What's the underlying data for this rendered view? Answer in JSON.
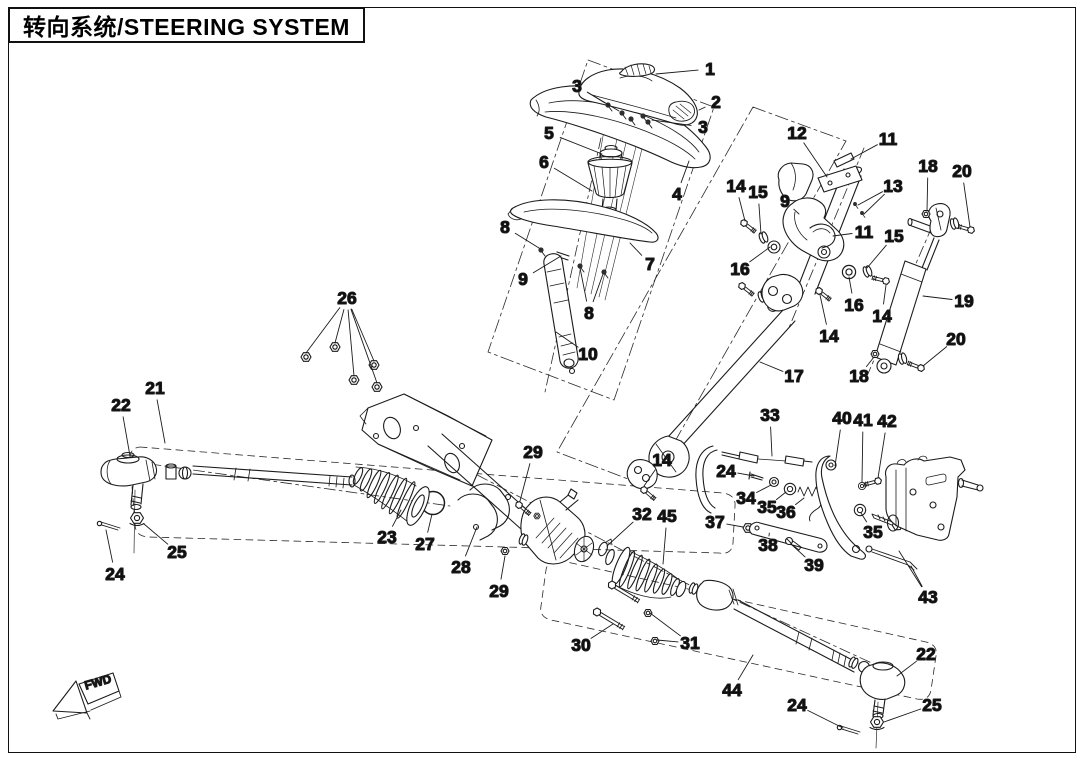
{
  "title": {
    "text": "转向系统/STEERING SYSTEM"
  },
  "fwd": {
    "label": "FWD"
  },
  "colors": {
    "ink": "#1b1b1b",
    "paper": "#ffffff"
  },
  "callouts": [
    {
      "n": "1",
      "x": 710,
      "y": 69,
      "t": [
        [
          656,
          74
        ]
      ]
    },
    {
      "n": "2",
      "x": 716,
      "y": 102,
      "t": [
        [
          699,
          110
        ]
      ]
    },
    {
      "n": "3",
      "x": 577,
      "y": 86,
      "t": [
        [
          605,
          103
        ],
        [
          619,
          111
        ]
      ]
    },
    {
      "n": "3",
      "x": 703,
      "y": 127,
      "t": [
        [
          652,
          120
        ]
      ]
    },
    {
      "n": "4",
      "x": 677,
      "y": 194,
      "t": [
        [
          689,
          161
        ]
      ]
    },
    {
      "n": "5",
      "x": 549,
      "y": 133,
      "t": [
        [
          602,
          154
        ]
      ]
    },
    {
      "n": "6",
      "x": 544,
      "y": 162,
      "t": [
        [
          592,
          191
        ]
      ]
    },
    {
      "n": "7",
      "x": 650,
      "y": 264,
      "t": [
        [
          630,
          243
        ]
      ]
    },
    {
      "n": "8",
      "x": 505,
      "y": 227,
      "t": [
        [
          539,
          248
        ]
      ]
    },
    {
      "n": "9",
      "x": 523,
      "y": 279,
      "t": [
        [
          561,
          256
        ]
      ]
    },
    {
      "n": "8",
      "x": 589,
      "y": 313,
      "t": [
        [
          580,
          268
        ],
        [
          603,
          274
        ]
      ]
    },
    {
      "n": "10",
      "x": 588,
      "y": 354,
      "t": [
        [
          556,
          332
        ]
      ]
    },
    {
      "n": "12",
      "x": 797,
      "y": 133,
      "t": [
        [
          827,
          177
        ]
      ]
    },
    {
      "n": "11",
      "x": 888,
      "y": 139,
      "t": [
        [
          851,
          159
        ]
      ]
    },
    {
      "n": "13",
      "x": 893,
      "y": 186,
      "t": [
        [
          858,
          205
        ],
        [
          864,
          214
        ]
      ]
    },
    {
      "n": "14",
      "x": 736,
      "y": 186,
      "t": [
        [
          745,
          221
        ]
      ]
    },
    {
      "n": "15",
      "x": 758,
      "y": 192,
      "t": [
        [
          761,
          234
        ]
      ]
    },
    {
      "n": "9",
      "x": 785,
      "y": 201,
      "t": [
        [
          799,
          214
        ]
      ]
    },
    {
      "n": "11",
      "x": 864,
      "y": 232,
      "t": [
        [
          833,
          236
        ]
      ]
    },
    {
      "n": "15",
      "x": 894,
      "y": 236,
      "t": [
        [
          867,
          268
        ]
      ]
    },
    {
      "n": "16",
      "x": 740,
      "y": 269,
      "t": [
        [
          770,
          247
        ]
      ]
    },
    {
      "n": "16",
      "x": 854,
      "y": 305,
      "t": [
        [
          849,
          277
        ]
      ]
    },
    {
      "n": "14",
      "x": 882,
      "y": 316,
      "t": [
        [
          886,
          285
        ]
      ]
    },
    {
      "n": "14",
      "x": 829,
      "y": 336,
      "t": [
        [
          820,
          295
        ]
      ]
    },
    {
      "n": "18",
      "x": 928,
      "y": 166,
      "t": [
        [
          927,
          211
        ]
      ]
    },
    {
      "n": "20",
      "x": 962,
      "y": 171,
      "t": [
        [
          970,
          227
        ]
      ]
    },
    {
      "n": "19",
      "x": 964,
      "y": 301,
      "t": [
        [
          923,
          296
        ]
      ]
    },
    {
      "n": "20",
      "x": 956,
      "y": 339,
      "t": [
        [
          923,
          366
        ]
      ]
    },
    {
      "n": "18",
      "x": 859,
      "y": 376,
      "t": [
        [
          874,
          357
        ]
      ]
    },
    {
      "n": "17",
      "x": 794,
      "y": 376,
      "t": [
        [
          760,
          362
        ]
      ]
    },
    {
      "n": "26",
      "x": 347,
      "y": 298,
      "t": [
        [
          306,
          353
        ],
        [
          335,
          343
        ],
        [
          354,
          376
        ],
        [
          374,
          361
        ],
        [
          377,
          383
        ]
      ]
    },
    {
      "n": "21",
      "x": 155,
      "y": 388,
      "t": [
        [
          165,
          443
        ]
      ]
    },
    {
      "n": "22",
      "x": 121,
      "y": 405,
      "t": [
        [
          130,
          456
        ]
      ]
    },
    {
      "n": "23",
      "x": 387,
      "y": 537,
      "t": [
        [
          401,
          510
        ]
      ]
    },
    {
      "n": "27",
      "x": 425,
      "y": 544,
      "t": [
        [
          432,
          514
        ]
      ]
    },
    {
      "n": "25",
      "x": 177,
      "y": 552,
      "t": [
        [
          144,
          524
        ]
      ]
    },
    {
      "n": "24",
      "x": 115,
      "y": 574,
      "t": [
        [
          106,
          530
        ]
      ]
    },
    {
      "n": "29",
      "x": 533,
      "y": 452,
      "t": [
        [
          520,
          501
        ]
      ]
    },
    {
      "n": "14",
      "x": 662,
      "y": 460,
      "t": [
        [
          644,
          486
        ]
      ]
    },
    {
      "n": "32",
      "x": 642,
      "y": 514,
      "t": [
        [
          607,
          546
        ]
      ]
    },
    {
      "n": "45",
      "x": 667,
      "y": 516,
      "t": [
        [
          663,
          564
        ]
      ]
    },
    {
      "n": "28",
      "x": 461,
      "y": 567,
      "t": [
        [
          477,
          527
        ]
      ]
    },
    {
      "n": "29",
      "x": 499,
      "y": 591,
      "t": [
        [
          505,
          556
        ]
      ]
    },
    {
      "n": "30",
      "x": 581,
      "y": 645,
      "t": [
        [
          613,
          624
        ]
      ]
    },
    {
      "n": "31",
      "x": 690,
      "y": 643,
      "t": [
        [
          650,
          613
        ],
        [
          657,
          640
        ]
      ]
    },
    {
      "n": "44",
      "x": 732,
      "y": 690,
      "t": [
        [
          753,
          655
        ]
      ]
    },
    {
      "n": "22",
      "x": 926,
      "y": 654,
      "t": [
        [
          897,
          676
        ]
      ]
    },
    {
      "n": "24",
      "x": 797,
      "y": 705,
      "t": [
        [
          843,
          728
        ]
      ]
    },
    {
      "n": "25",
      "x": 932,
      "y": 705,
      "t": [
        [
          884,
          722
        ]
      ]
    },
    {
      "n": "33",
      "x": 770,
      "y": 415,
      "t": [
        [
          772,
          456
        ]
      ]
    },
    {
      "n": "24",
      "x": 726,
      "y": 471,
      "t": [
        [
          754,
          476
        ]
      ]
    },
    {
      "n": "34",
      "x": 746,
      "y": 498,
      "t": [
        [
          771,
          485
        ]
      ]
    },
    {
      "n": "35",
      "x": 767,
      "y": 507,
      "t": [
        [
          786,
          492
        ]
      ]
    },
    {
      "n": "36",
      "x": 786,
      "y": 512,
      "t": [
        [
          804,
          498
        ]
      ]
    },
    {
      "n": "37",
      "x": 715,
      "y": 522,
      "t": [
        [
          743,
          527
        ]
      ]
    },
    {
      "n": "38",
      "x": 768,
      "y": 545,
      "t": [
        [
          769,
          536
        ]
      ]
    },
    {
      "n": "39",
      "x": 814,
      "y": 565,
      "t": [
        [
          792,
          545
        ]
      ]
    },
    {
      "n": "40",
      "x": 842,
      "y": 418,
      "t": [
        [
          835,
          466
        ]
      ]
    },
    {
      "n": "41",
      "x": 863,
      "y": 420,
      "t": [
        [
          862,
          482
        ]
      ]
    },
    {
      "n": "42",
      "x": 887,
      "y": 421,
      "t": [
        [
          878,
          478
        ]
      ]
    },
    {
      "n": "35",
      "x": 873,
      "y": 532,
      "t": [
        [
          861,
          513
        ]
      ]
    },
    {
      "n": "43",
      "x": 928,
      "y": 597,
      "t": [
        [
          899,
          551
        ],
        [
          911,
          566
        ]
      ]
    }
  ]
}
